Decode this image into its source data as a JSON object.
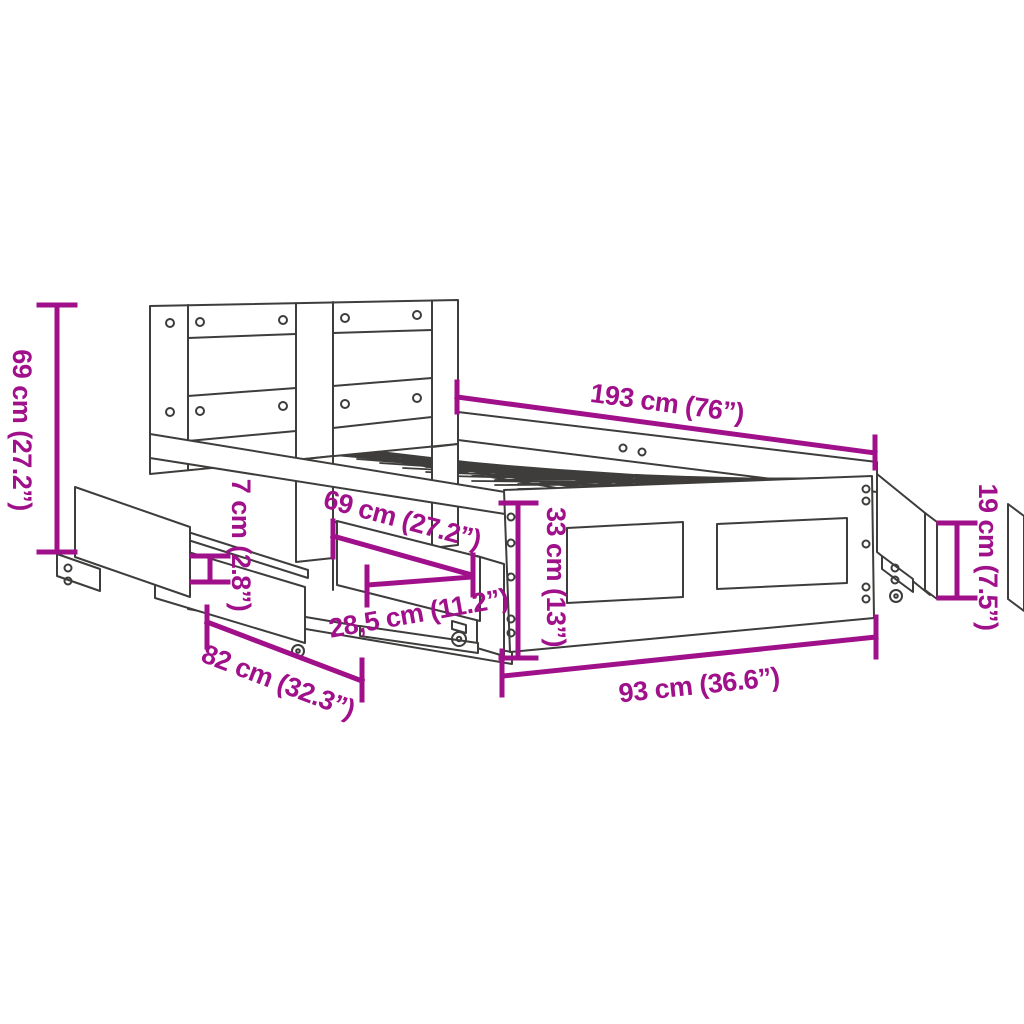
{
  "diagram": {
    "description": "Line drawing of a bed frame with headboard and pull-out storage drawers, annotated with product dimensions",
    "background_color": "#ffffff",
    "line_color": "#3E3D3B",
    "accent_color": "#A0108A",
    "dimensions": [
      {
        "id": "headboard-height",
        "label": "69 cm (27.2”)",
        "orientation": "vertical-left"
      },
      {
        "id": "bed-length",
        "label": "193 cm (76”)",
        "orientation": "diagonal-top"
      },
      {
        "id": "drawer-front-width",
        "label": "69 cm (27.2”)",
        "orientation": "diagonal-middle"
      },
      {
        "id": "drawer-inner-depth",
        "label": "28,5 cm (11.2”)",
        "orientation": "diagonal-middle"
      },
      {
        "id": "side-rail-height",
        "label": "33 cm (13”)",
        "orientation": "vertical-middle"
      },
      {
        "id": "slide-rail-height",
        "label": "7 cm (2.8”)",
        "orientation": "vertical-small"
      },
      {
        "id": "drawer-extension",
        "label": "82 cm (32.3”)",
        "orientation": "diagonal-bottom-left"
      },
      {
        "id": "bed-width",
        "label": "93 cm (36.6”)",
        "orientation": "diagonal-bottom"
      },
      {
        "id": "foot-drawer-height",
        "label": "19 cm (7.5”)",
        "orientation": "vertical-right"
      }
    ]
  }
}
